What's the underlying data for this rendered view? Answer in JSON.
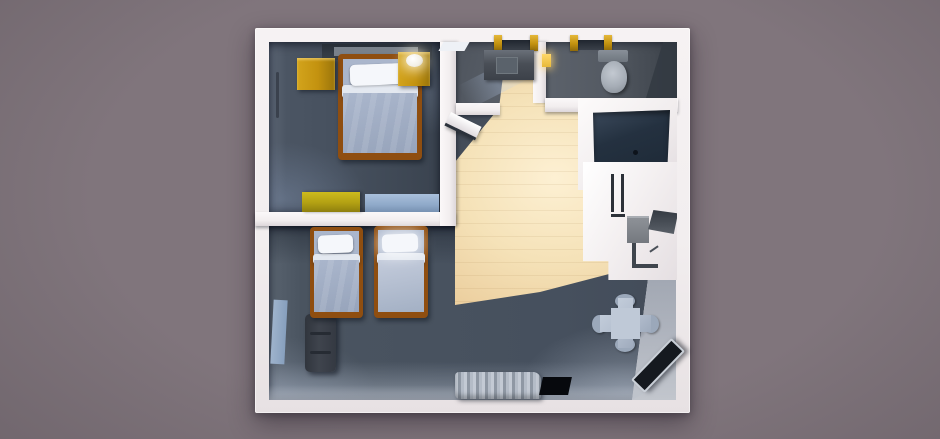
{
  "scene": {
    "description": "3D top-down architectural render of a hotel suite floor plan on a muted purple-gray background, with white walls, dark slate floors and a warm light pool across the tiled hallway",
    "rooms": [
      {
        "id": "bedroom",
        "label": "Bedroom with single bed"
      },
      {
        "id": "living-room",
        "label": "Living room with two twin beds"
      },
      {
        "id": "vanity-room",
        "label": "Bathroom vanity area"
      },
      {
        "id": "toilet-room",
        "label": "Toilet room"
      },
      {
        "id": "hallway",
        "label": "Entry hallway"
      },
      {
        "id": "kitchenette",
        "label": "Kitchenette"
      },
      {
        "id": "bathtub-nook",
        "label": "Bathtub nook"
      }
    ],
    "furniture": [
      "single-bed",
      "nightstand-left",
      "nightstand-right",
      "table-lamp",
      "headboard-shelf",
      "dresser",
      "bench",
      "twin-bed-left",
      "twin-bed-right",
      "sofa",
      "rug",
      "dining-table",
      "dining-chairs",
      "curtains",
      "window-opening",
      "tv",
      "toilet",
      "vanity-sink",
      "bathtub",
      "fridge",
      "cooktop",
      "counter"
    ],
    "door_frames": 2
  },
  "colors": {
    "background": "#80757c",
    "background-edge": "#6d636a",
    "wall-white": "#f2eeef",
    "floor-slate": "#46505e",
    "floor-slate-dark": "#3a434f",
    "floor-bath": "#545a63",
    "floor-lit": "#f5e2b8",
    "floor-lit-bright": "#fdf0d3",
    "gold": "#c3920f",
    "gold-dark": "#8f6a0a",
    "bed-frame": "#8f4e10",
    "blanket": "#aab6cc",
    "pillow": "#f5f7fb",
    "bench-blue": "#8fa9c9",
    "sofa-gray": "#3f444d",
    "tub-navy": "#243140",
    "toilet-gray": "#a6adb6",
    "counter-gray": "#4a4f57",
    "table-gray": "#b2bdcd",
    "chair-gray": "#9ba8ba",
    "curtain-gray": "#b4bcc7",
    "tv-black": "#15191f"
  }
}
